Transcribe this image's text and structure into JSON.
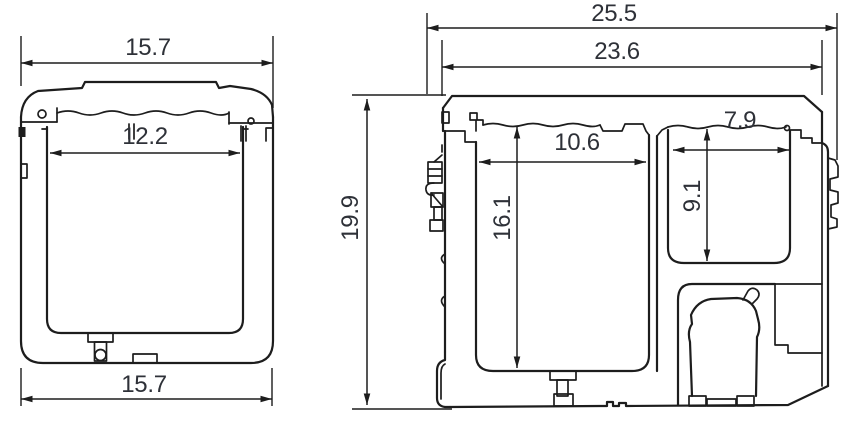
{
  "colors": {
    "line": "#1d1d1d",
    "text": "#2e3138",
    "background": "#ffffff"
  },
  "side_view": {
    "top_width": "15.7",
    "inner_width": "12.2",
    "bottom_width": "15.7"
  },
  "front_view": {
    "overall_width": "25.5",
    "lid_width": "23.6",
    "overall_height": "19.9",
    "main_inner_width": "10.6",
    "main_inner_height": "16.1",
    "small_inner_width": "7.9",
    "small_inner_height": "9.1"
  }
}
